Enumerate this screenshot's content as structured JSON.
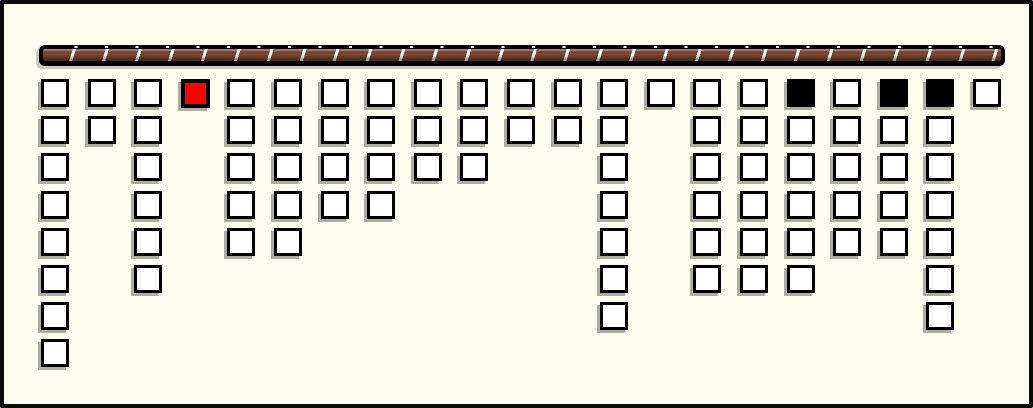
{
  "window": {
    "width": 1033,
    "height": 408,
    "background": "#FDFDEF",
    "border_color": "#0A0A0A"
  },
  "bar": {
    "description": "horizontal striped rope bar with rounded ends",
    "left": 35,
    "top": 41,
    "width": 966,
    "height": 21,
    "frame_color": "#000000",
    "stripe_color": "#7B4533",
    "divider_color": "#FFFFFF",
    "segment_period_px": 32.5
  },
  "board": {
    "square_size": 28,
    "col_start_x": 37,
    "col_step_x": 46.6,
    "row_start_y": 75,
    "row_step_y": 37.2,
    "square_fill": "#FFFFFF",
    "square_border": "#000000",
    "red_fill": "#FF0000",
    "black_fill": "#000000",
    "shadow_color": "#ADADA3",
    "columns": [
      [
        "white",
        "white",
        "white",
        "white",
        "white",
        "white",
        "white",
        "white"
      ],
      [
        "white",
        "white"
      ],
      [
        "white",
        "white",
        "white",
        "white",
        "white",
        "white"
      ],
      [
        "red"
      ],
      [
        "white",
        "white",
        "white",
        "white",
        "white"
      ],
      [
        "white",
        "white",
        "white",
        "white",
        "white"
      ],
      [
        "white",
        "white",
        "white",
        "white"
      ],
      [
        "white",
        "white",
        "white",
        "white"
      ],
      [
        "white",
        "white",
        "white"
      ],
      [
        "white",
        "white",
        "white"
      ],
      [
        "white",
        "white"
      ],
      [
        "white",
        "white"
      ],
      [
        "white",
        "white",
        "white",
        "white",
        "white",
        "white",
        "white"
      ],
      [
        "white"
      ],
      [
        "white",
        "white",
        "white",
        "white",
        "white",
        "white"
      ],
      [
        "white",
        "white",
        "white",
        "white",
        "white",
        "white"
      ],
      [
        "black",
        "white",
        "white",
        "white",
        "white",
        "white"
      ],
      [
        "white",
        "white",
        "white",
        "white",
        "white"
      ],
      [
        "black",
        "white",
        "white",
        "white",
        "white"
      ],
      [
        "black",
        "white",
        "white",
        "white",
        "white",
        "white",
        "white"
      ],
      [
        "white"
      ]
    ]
  },
  "counts": {
    "column_count": 21,
    "total_squares": 89,
    "white_squares": 85,
    "red_squares": 1,
    "black_squares": 3
  }
}
